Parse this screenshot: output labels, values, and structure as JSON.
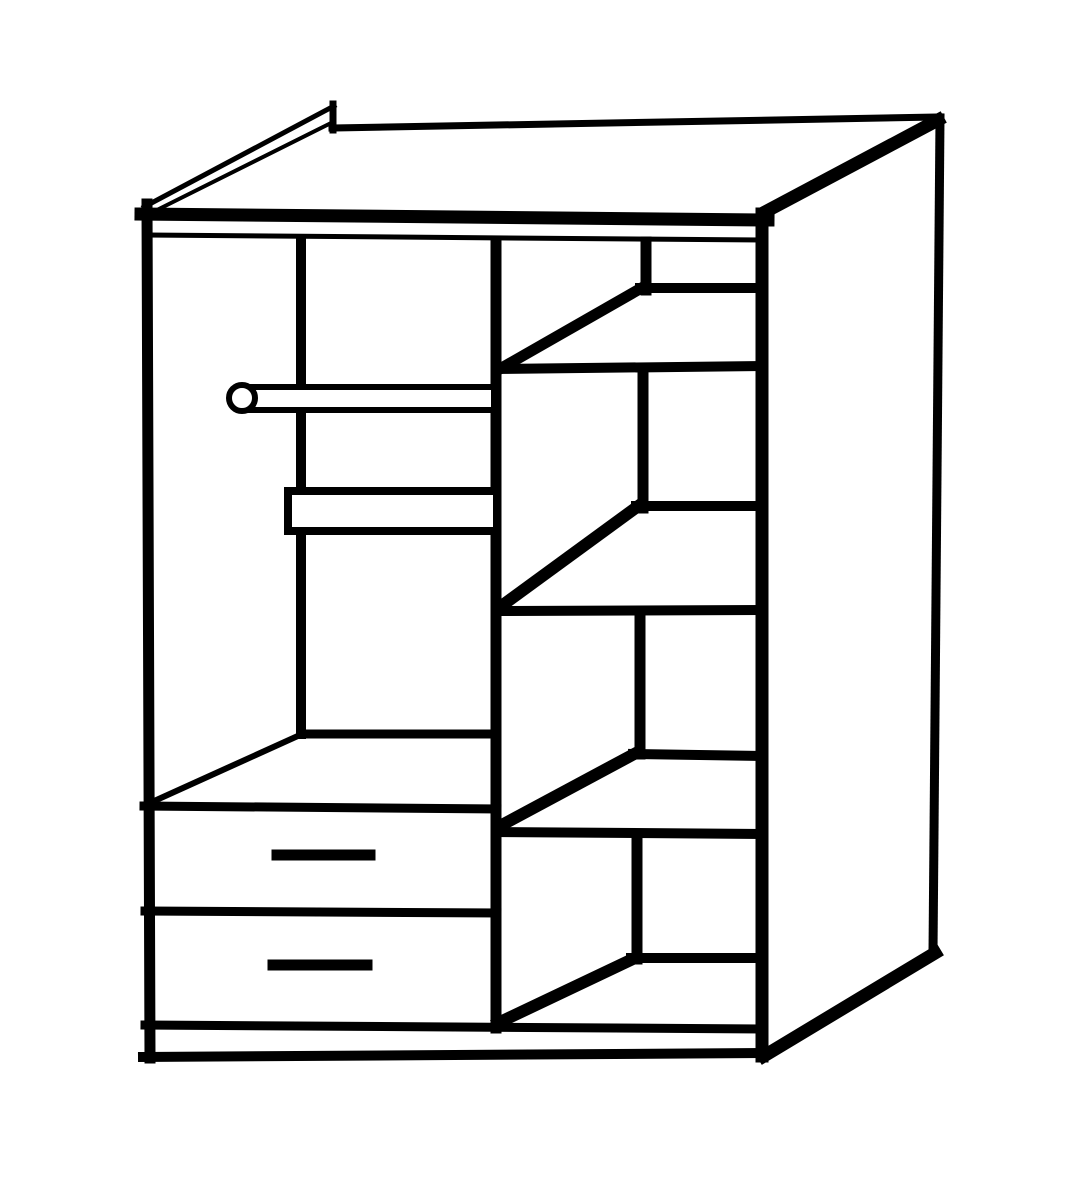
{
  "figure": {
    "subject": "wardrobe-interior-line-drawing",
    "style": "black line art on white",
    "ink": "#000000",
    "background": "#ffffff",
    "canvas": {
      "width": 1092,
      "height": 1200
    }
  },
  "elements": [
    {
      "type": "line",
      "name": "center-back-corner-line",
      "x1": 301,
      "y1": 243,
      "x2": 301,
      "y2": 734,
      "w": 10
    },
    {
      "type": "line",
      "name": "center-divider",
      "x1": 496,
      "y1": 241,
      "x2": 496,
      "y2": 1028,
      "w": 11
    },
    {
      "type": "line",
      "name": "left-side-panel-edge",
      "x1": 147,
      "y1": 204,
      "x2": 150,
      "y2": 1058,
      "w": 11
    },
    {
      "type": "line",
      "name": "top-panel-front-edge",
      "x1": 141,
      "y1": 214,
      "x2": 768,
      "y2": 220,
      "w": 13
    },
    {
      "type": "line",
      "name": "interior-ceiling-line",
      "x1": 147,
      "y1": 235,
      "x2": 760,
      "y2": 240,
      "w": 5
    },
    {
      "type": "line",
      "name": "top-panel-left-edge-outer",
      "x1": 144,
      "y1": 207,
      "x2": 334,
      "y2": 106,
      "w": 5
    },
    {
      "type": "line",
      "name": "top-panel-left-edge-inner",
      "x1": 151,
      "y1": 213,
      "x2": 331,
      "y2": 123,
      "w": 4
    },
    {
      "type": "line",
      "name": "top-panel-corner-cap",
      "x1": 333,
      "y1": 104,
      "x2": 333,
      "y2": 130,
      "w": 7
    },
    {
      "type": "line",
      "name": "top-panel-back-edge",
      "x1": 332,
      "y1": 128,
      "x2": 940,
      "y2": 117,
      "w": 7
    },
    {
      "type": "line",
      "name": "right-side-panel-back-edge",
      "x1": 940,
      "y1": 118,
      "x2": 933,
      "y2": 953,
      "w": 9
    },
    {
      "type": "line",
      "name": "right-side-panel-top-edge",
      "x1": 765,
      "y1": 212,
      "x2": 938,
      "y2": 120,
      "w": 13
    },
    {
      "type": "line",
      "name": "right-side-panel-bottom-edge",
      "x1": 764,
      "y1": 1056,
      "x2": 935,
      "y2": 953,
      "w": 13
    },
    {
      "type": "line",
      "name": "cabinet-front-right-edge",
      "x1": 762,
      "y1": 214,
      "x2": 762,
      "y2": 1056,
      "w": 13
    },
    {
      "type": "line",
      "name": "shelf-wall-1",
      "x1": 646,
      "y1": 242,
      "x2": 646,
      "y2": 290,
      "w": 11
    },
    {
      "type": "line",
      "name": "shelf-1-back-edge",
      "x1": 640,
      "y1": 288,
      "x2": 763,
      "y2": 288,
      "w": 10
    },
    {
      "type": "line",
      "name": "shelf-1-diagonal",
      "x1": 645,
      "y1": 286,
      "x2": 498,
      "y2": 370,
      "w": 11
    },
    {
      "type": "line",
      "name": "shelf-1-front-edge",
      "x1": 496,
      "y1": 369,
      "x2": 763,
      "y2": 366,
      "w": 10
    },
    {
      "type": "line",
      "name": "shelf-wall-2",
      "x1": 643,
      "y1": 368,
      "x2": 643,
      "y2": 508,
      "w": 11
    },
    {
      "type": "line",
      "name": "shelf-2-back-edge",
      "x1": 636,
      "y1": 506,
      "x2": 763,
      "y2": 506,
      "w": 10
    },
    {
      "type": "line",
      "name": "shelf-2-diagonal",
      "x1": 641,
      "y1": 504,
      "x2": 500,
      "y2": 607,
      "w": 12
    },
    {
      "type": "line",
      "name": "shelf-2-front-edge",
      "x1": 496,
      "y1": 611,
      "x2": 763,
      "y2": 610,
      "w": 10
    },
    {
      "type": "line",
      "name": "shelf-wall-3",
      "x1": 640,
      "y1": 612,
      "x2": 640,
      "y2": 754,
      "w": 11
    },
    {
      "type": "line",
      "name": "shelf-3-back-edge",
      "x1": 633,
      "y1": 754,
      "x2": 763,
      "y2": 756,
      "w": 10
    },
    {
      "type": "line",
      "name": "shelf-3-diagonal",
      "x1": 636,
      "y1": 753,
      "x2": 500,
      "y2": 826,
      "w": 12
    },
    {
      "type": "line",
      "name": "shelf-3-front-edge",
      "x1": 496,
      "y1": 832,
      "x2": 763,
      "y2": 834,
      "w": 10
    },
    {
      "type": "line",
      "name": "shelf-wall-4",
      "x1": 637,
      "y1": 836,
      "x2": 637,
      "y2": 959,
      "w": 11
    },
    {
      "type": "line",
      "name": "shelf-4-back-edge",
      "x1": 631,
      "y1": 958,
      "x2": 763,
      "y2": 958,
      "w": 10
    },
    {
      "type": "line",
      "name": "shelf-4-diagonal",
      "x1": 635,
      "y1": 958,
      "x2": 498,
      "y2": 1023,
      "w": 12
    },
    {
      "type": "line",
      "name": "floor-back-edge",
      "x1": 304,
      "y1": 734,
      "x2": 494,
      "y2": 734,
      "w": 9
    },
    {
      "type": "line",
      "name": "floor-left-edge",
      "x1": 152,
      "y1": 802,
      "x2": 300,
      "y2": 735,
      "w": 6
    },
    {
      "type": "line",
      "name": "drawer-top-edge",
      "x1": 144,
      "y1": 806,
      "x2": 497,
      "y2": 809,
      "w": 9
    },
    {
      "type": "line",
      "name": "drawer-separator",
      "x1": 145,
      "y1": 911,
      "x2": 497,
      "y2": 913,
      "w": 9
    },
    {
      "type": "line",
      "name": "drawer-1-handle",
      "x1": 277,
      "y1": 855,
      "x2": 370,
      "y2": 855,
      "w": 11
    },
    {
      "type": "line",
      "name": "drawer-2-handle",
      "x1": 273,
      "y1": 965,
      "x2": 367,
      "y2": 965,
      "w": 11
    },
    {
      "type": "line",
      "name": "plinth-top-edge",
      "x1": 145,
      "y1": 1025,
      "x2": 762,
      "y2": 1029,
      "w": 9
    },
    {
      "type": "line",
      "name": "base-bottom-edge",
      "x1": 143,
      "y1": 1057,
      "x2": 766,
      "y2": 1053,
      "w": 10
    },
    {
      "type": "rect",
      "name": "support-board",
      "x": 288,
      "y": 491,
      "width": 209,
      "height": 40,
      "w": 8
    },
    {
      "type": "rect",
      "name": "hanging-rail-bar",
      "x": 248,
      "y": 387,
      "width": 246,
      "height": 23,
      "w": 6
    },
    {
      "type": "circle",
      "name": "hanging-rail-end-cap",
      "cx": 242,
      "cy": 398,
      "r": 13,
      "w": 6
    }
  ]
}
